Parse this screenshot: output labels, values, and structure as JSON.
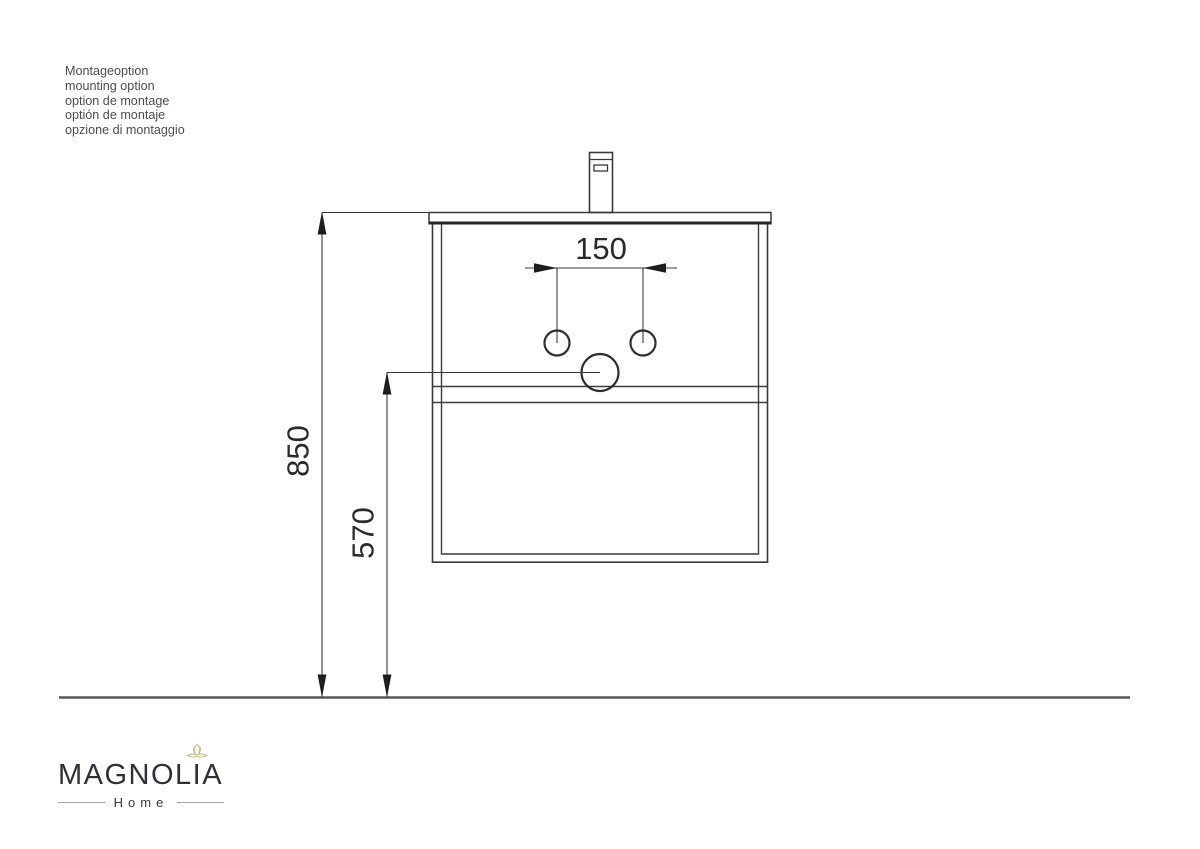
{
  "notes": {
    "lines": [
      "Montageoption",
      "mounting option",
      "option de montage",
      "optión de montaje",
      "opzione di montaggio"
    ]
  },
  "drawing": {
    "type": "vanity-mounting-elevation",
    "dimensions": {
      "faucet_hole_spacing": "150",
      "mounting_height": "850",
      "drain_height": "570"
    },
    "unit_implied": "mm",
    "line_color": "#3a3a3a",
    "thick_line_color": "#262626",
    "floor_line_color": "#585858",
    "dimension_text_color": "#2a2a2a"
  },
  "logo": {
    "name": "MAGNOLIA",
    "subtitle": "Home",
    "flower_color": "#c2b688"
  }
}
